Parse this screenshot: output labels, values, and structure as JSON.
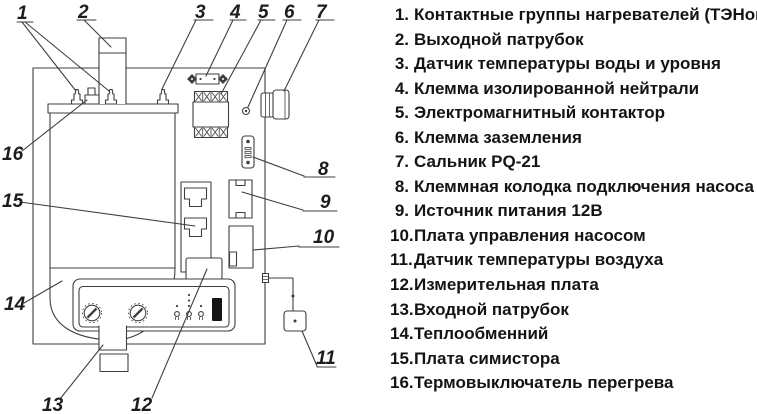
{
  "diagram": {
    "callouts": [
      "1",
      "2",
      "3",
      "4",
      "5",
      "6",
      "7",
      "8",
      "9",
      "10",
      "11",
      "12",
      "13",
      "14",
      "15",
      "16"
    ]
  },
  "legend": {
    "items": [
      {
        "num": "1.",
        "text": "Контактные группы нагревателей (ТЭНов)"
      },
      {
        "num": "2.",
        "text": "Выходной патрубок"
      },
      {
        "num": "3.",
        "text": "Датчик температуры воды и уровня"
      },
      {
        "num": "4.",
        "text": "Клемма изолированной нейтрали"
      },
      {
        "num": "5.",
        "text": "Электромагнитный контактор"
      },
      {
        "num": "6.",
        "text": "Клемма заземления"
      },
      {
        "num": "7.",
        "text": "Сальник PQ-21"
      },
      {
        "num": "8.",
        "text": "Клеммная колодка подключения насоса"
      },
      {
        "num": "9.",
        "text": "Источник питания 12В"
      },
      {
        "num": "10.",
        "text": "Плата управления насосом"
      },
      {
        "num": "11.",
        "text": "Датчик температуры воздуха"
      },
      {
        "num": "12.",
        "text": "Измерительная плата"
      },
      {
        "num": "13.",
        "text": "Входной патрубок"
      },
      {
        "num": "14.",
        "text": "Теплообменний"
      },
      {
        "num": "15.",
        "text": "Плата симистора"
      },
      {
        "num": "16.",
        "text": "Термовыключатель перегрева"
      }
    ]
  }
}
